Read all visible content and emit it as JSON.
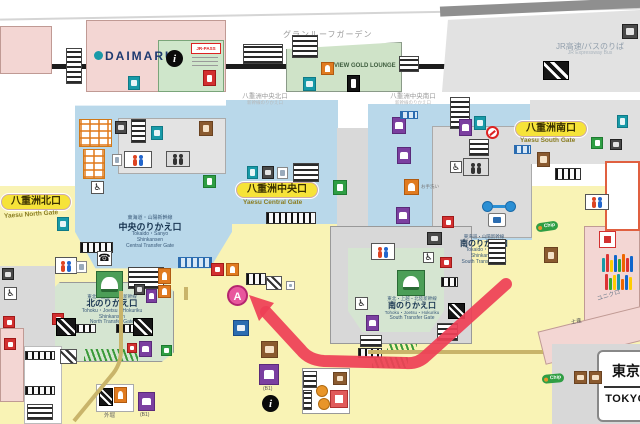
{
  "station_sign": {
    "jp": "東京",
    "en": "TOKYO"
  },
  "top_area": {
    "granroof_label": "グランルーフガーデン",
    "view_gold_lounge": "VIEW GOLD LOUNGE",
    "daimaru": "DAIMARU",
    "jr_pass": "JR-PASS",
    "bus_jp": "JR高速/バスのりば",
    "bus_en": "JR Expressway Bus",
    "central_north_gate": "八重洲中央北口",
    "central_north_sub": "新幹線のりかえ口",
    "central_south_gate": "八重洲中央南口",
    "central_south_sub": "新幹線のりかえ口"
  },
  "gates": {
    "north_jp": "八重洲北口",
    "north_en": "Yaesu North Gate",
    "central_jp": "八重洲中央口",
    "central_en": "Yaesu Central Gate",
    "south_jp": "八重洲南口",
    "south_en": "Yaesu South Gate"
  },
  "transfer": {
    "central": {
      "line": "東海道・山陽新幹線",
      "name": "中央のりかえ口",
      "en1": "Tokaido・Sanyo",
      "en2": "Shinkansen",
      "en3": "Central Transfer Gate"
    },
    "north": {
      "line": "東北・上越・北陸新幹線",
      "name": "北のりかえ口",
      "en1": "Tohoku・Joetsu・Hokuriku",
      "en2": "Shinkansen",
      "en3": "North Transfer Gate"
    },
    "south_tokaido": {
      "line": "東海道・山陽新幹線",
      "name": "南のりかえ口",
      "en1": "Tokaido・Sanyo",
      "en2": "Shinkansen",
      "en3": "South Transfer Gate"
    },
    "south_tohoku": {
      "line": "東北・上越・北陸新幹線",
      "name": "南のりかえ口",
      "en1": "Tohoku・Joetsu・Hokuriku",
      "en2": "South Transfer Gate"
    }
  },
  "labels": {
    "uniqlo": "ユニクロ",
    "miyage": "土産",
    "sotobori": "外堀",
    "otearai": "お手洗い",
    "b1": "(B1)",
    "chip": "Chip",
    "marker_a": "A"
  },
  "icon_glyphs": {
    "info": "i",
    "phone": "☎",
    "wheel": "♿"
  },
  "colors": {
    "arrow": "#ee4056",
    "marker": "#e8579d",
    "marker_ring": "#b5256f",
    "concourse_blue": "#b9d8ea",
    "passage_yellow": "#f9f3b5",
    "building_pink": "#f3d6d3",
    "shinkansen_green": "#d5e5d1",
    "gate_pill": "#f6e339"
  },
  "icons_layout": [
    [
      "stairs",
      66,
      48,
      16,
      36
    ],
    [
      "teal",
      128,
      76,
      12,
      14
    ],
    [
      "info",
      166,
      50,
      17,
      17
    ],
    [
      "red",
      203,
      70,
      13,
      16
    ],
    [
      "stairs",
      243,
      44,
      40,
      20
    ],
    [
      "stairs",
      292,
      35,
      26,
      23
    ],
    [
      "orange",
      321,
      62,
      13,
      13
    ],
    [
      "teal",
      303,
      77,
      13,
      14
    ],
    [
      "black",
      347,
      75,
      13,
      17
    ],
    [
      "stairs",
      399,
      56,
      20,
      16
    ],
    [
      "esc",
      543,
      61,
      26,
      19
    ],
    [
      "dark",
      622,
      24,
      16,
      15
    ],
    [
      "stairs",
      450,
      97,
      20,
      32
    ],
    [
      "lockers",
      79,
      119,
      33,
      28
    ],
    [
      "lockers",
      83,
      149,
      22,
      30
    ],
    [
      "dark",
      115,
      121,
      12,
      13
    ],
    [
      "stairs",
      131,
      119,
      15,
      24
    ],
    [
      "teal",
      151,
      126,
      12,
      14
    ],
    [
      "brown",
      199,
      121,
      14,
      15
    ],
    [
      "toilet",
      124,
      151,
      28,
      17
    ],
    [
      "white",
      112,
      154,
      10,
      12
    ],
    [
      "elev",
      166,
      151,
      24,
      16
    ],
    [
      "green",
      203,
      175,
      13,
      13
    ],
    [
      "wheel",
      91,
      181,
      13,
      13
    ],
    [
      "teal",
      57,
      217,
      12,
      14
    ],
    [
      "comb",
      80,
      242,
      33,
      11
    ],
    [
      "teal",
      247,
      166,
      11,
      13
    ],
    [
      "dark",
      262,
      166,
      12,
      13
    ],
    [
      "white",
      277,
      167,
      11,
      12
    ],
    [
      "stairs",
      293,
      163,
      26,
      19
    ],
    [
      "comb",
      266,
      212,
      50,
      12
    ],
    [
      "green",
      333,
      180,
      14,
      15
    ],
    [
      "orange",
      404,
      179,
      15,
      16
    ],
    [
      "purple",
      392,
      117,
      14,
      17
    ],
    [
      "purple",
      397,
      147,
      14,
      17
    ],
    [
      "purple",
      396,
      207,
      14,
      17
    ],
    [
      "combblue",
      400,
      111,
      18,
      8
    ],
    [
      "phone",
      97,
      251,
      15,
      15
    ],
    [
      "train",
      96,
      271,
      27,
      27
    ],
    [
      "stairs",
      128,
      267,
      36,
      22
    ],
    [
      "combblue",
      178,
      257,
      34,
      11
    ],
    [
      "orange",
      158,
      268,
      13,
      16
    ],
    [
      "orange",
      158,
      285,
      13,
      13
    ],
    [
      "red",
      211,
      263,
      13,
      13
    ],
    [
      "orange",
      226,
      263,
      13,
      13
    ],
    [
      "toilet",
      55,
      257,
      22,
      17
    ],
    [
      "white",
      76,
      261,
      11,
      12
    ],
    [
      "dark",
      134,
      284,
      11,
      11
    ],
    [
      "purple",
      146,
      289,
      11,
      14
    ],
    [
      "red",
      52,
      313,
      12,
      12
    ],
    [
      "esc",
      56,
      318,
      20,
      18
    ],
    [
      "comb",
      76,
      324,
      20,
      9
    ],
    [
      "comb",
      116,
      324,
      18,
      9
    ],
    [
      "esc",
      133,
      318,
      20,
      18
    ],
    [
      "combgreen",
      84,
      349,
      54,
      12
    ],
    [
      "red",
      127,
      343,
      10,
      10
    ],
    [
      "purple",
      139,
      341,
      13,
      16
    ],
    [
      "green",
      161,
      345,
      11,
      11
    ],
    [
      "escw",
      60,
      349,
      17,
      15
    ],
    [
      "wheel",
      4,
      287,
      13,
      13
    ],
    [
      "red",
      3,
      316,
      12,
      12
    ],
    [
      "dark",
      2,
      268,
      12,
      12
    ],
    [
      "red",
      4,
      338,
      12,
      12
    ],
    [
      "comb",
      25,
      351,
      30,
      9
    ],
    [
      "comb",
      25,
      386,
      30,
      9
    ],
    [
      "stairs",
      27,
      404,
      26,
      16
    ],
    [
      "esc",
      99,
      388,
      14,
      18
    ],
    [
      "orange",
      114,
      387,
      13,
      16
    ],
    [
      "blue",
      233,
      320,
      16,
      16
    ],
    [
      "brown",
      261,
      341,
      17,
      17
    ],
    [
      "purple",
      259,
      364,
      20,
      21
    ],
    [
      "info",
      262,
      395,
      17,
      17
    ],
    [
      "stairs",
      303,
      371,
      14,
      17
    ],
    [
      "circleO",
      316,
      385,
      12,
      12
    ],
    [
      "circleO",
      318,
      398,
      12,
      12
    ],
    [
      "brown",
      333,
      372,
      14,
      13
    ],
    [
      "redbox",
      330,
      390,
      18,
      18
    ],
    [
      "stairs",
      303,
      390,
      9,
      20
    ],
    [
      "stairs",
      360,
      335,
      22,
      12
    ],
    [
      "comb",
      358,
      348,
      24,
      10
    ],
    [
      "combgreen",
      372,
      357,
      36,
      11
    ],
    [
      "escw",
      266,
      276,
      16,
      14
    ],
    [
      "comb",
      246,
      273,
      20,
      12
    ],
    [
      "white",
      286,
      281,
      9,
      9
    ],
    [
      "purple",
      138,
      392,
      17,
      19
    ],
    [
      "train",
      397,
      270,
      28,
      26
    ],
    [
      "comb",
      441,
      277,
      17,
      10
    ],
    [
      "stairs",
      437,
      323,
      21,
      18
    ],
    [
      "purple",
      366,
      315,
      13,
      16
    ],
    [
      "wheel",
      355,
      297,
      13,
      13
    ],
    [
      "dark",
      427,
      232,
      15,
      13
    ],
    [
      "red",
      442,
      216,
      12,
      12
    ],
    [
      "red",
      440,
      257,
      12,
      11
    ],
    [
      "esc",
      448,
      303,
      17,
      16
    ],
    [
      "combgreen",
      387,
      344,
      30,
      9
    ],
    [
      "toilet",
      371,
      243,
      24,
      17
    ],
    [
      "wheel",
      423,
      252,
      11,
      11
    ],
    [
      "teal",
      474,
      116,
      12,
      14
    ],
    [
      "purple",
      459,
      119,
      13,
      17
    ],
    [
      "noentry",
      486,
      126,
      13,
      13
    ],
    [
      "stairs",
      469,
      139,
      20,
      17
    ],
    [
      "elev",
      463,
      158,
      26,
      18
    ],
    [
      "wheel",
      450,
      161,
      12,
      12
    ],
    [
      "combblue",
      514,
      145,
      17,
      9
    ],
    [
      "comb",
      555,
      168,
      26,
      12
    ],
    [
      "teal",
      617,
      115,
      11,
      13
    ],
    [
      "green",
      591,
      137,
      12,
      12
    ],
    [
      "dark",
      610,
      139,
      12,
      11
    ],
    [
      "brown",
      537,
      152,
      13,
      15
    ],
    [
      "toilet",
      585,
      194,
      24,
      16
    ],
    [
      "link",
      482,
      200,
      34,
      13
    ],
    [
      "flag",
      488,
      213,
      18,
      14
    ],
    [
      "stairs",
      488,
      239,
      18,
      26
    ],
    [
      "redsq",
      599,
      231,
      17,
      17
    ],
    [
      "brown",
      544,
      247,
      14,
      16
    ],
    [
      "brown",
      574,
      371,
      13,
      13
    ],
    [
      "brown",
      589,
      371,
      13,
      13
    ]
  ]
}
